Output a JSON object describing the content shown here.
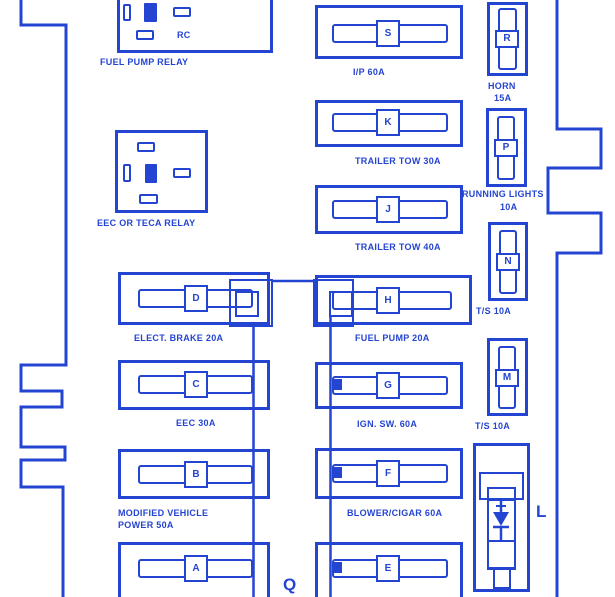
{
  "colors": {
    "ink": "#2444d2",
    "background": "#ffffff"
  },
  "relays": {
    "fuel_pump": {
      "label": "FUEL PUMP RELAY",
      "code": "RC"
    },
    "eec": {
      "label": "EEC OR TECA RELAY"
    }
  },
  "left_column": [
    {
      "letter": "D",
      "label": "ELECT. BRAKE 20A"
    },
    {
      "letter": "C",
      "label": "EEC 30A"
    },
    {
      "letter": "B",
      "label_line1": "MODIFIED VEHICLE",
      "label_line2": "POWER 50A"
    },
    {
      "letter": "A"
    }
  ],
  "middle_column": [
    {
      "letter": "S",
      "label": "I/P 60A"
    },
    {
      "letter": "K",
      "label": "TRAILER TOW 30A"
    },
    {
      "letter": "J",
      "label": "TRAILER TOW 40A"
    },
    {
      "letter": "H",
      "label": "FUEL PUMP 20A"
    },
    {
      "letter": "G",
      "label": "IGN. SW. 60A"
    },
    {
      "letter": "F",
      "label": "BLOWER/CIGAR 60A"
    },
    {
      "letter": "E"
    }
  ],
  "right_column": [
    {
      "letter": "R",
      "label_line1": "HORN",
      "label_line2": "15A"
    },
    {
      "letter": "P",
      "label_line1": "RUNNING LIGHTS",
      "label_line2": "10A"
    },
    {
      "letter": "N",
      "label": "T/S 10A"
    },
    {
      "letter": "M",
      "label": "T/S 10A"
    }
  ],
  "module": {
    "letter": "L"
  },
  "connector_letter": "Q"
}
